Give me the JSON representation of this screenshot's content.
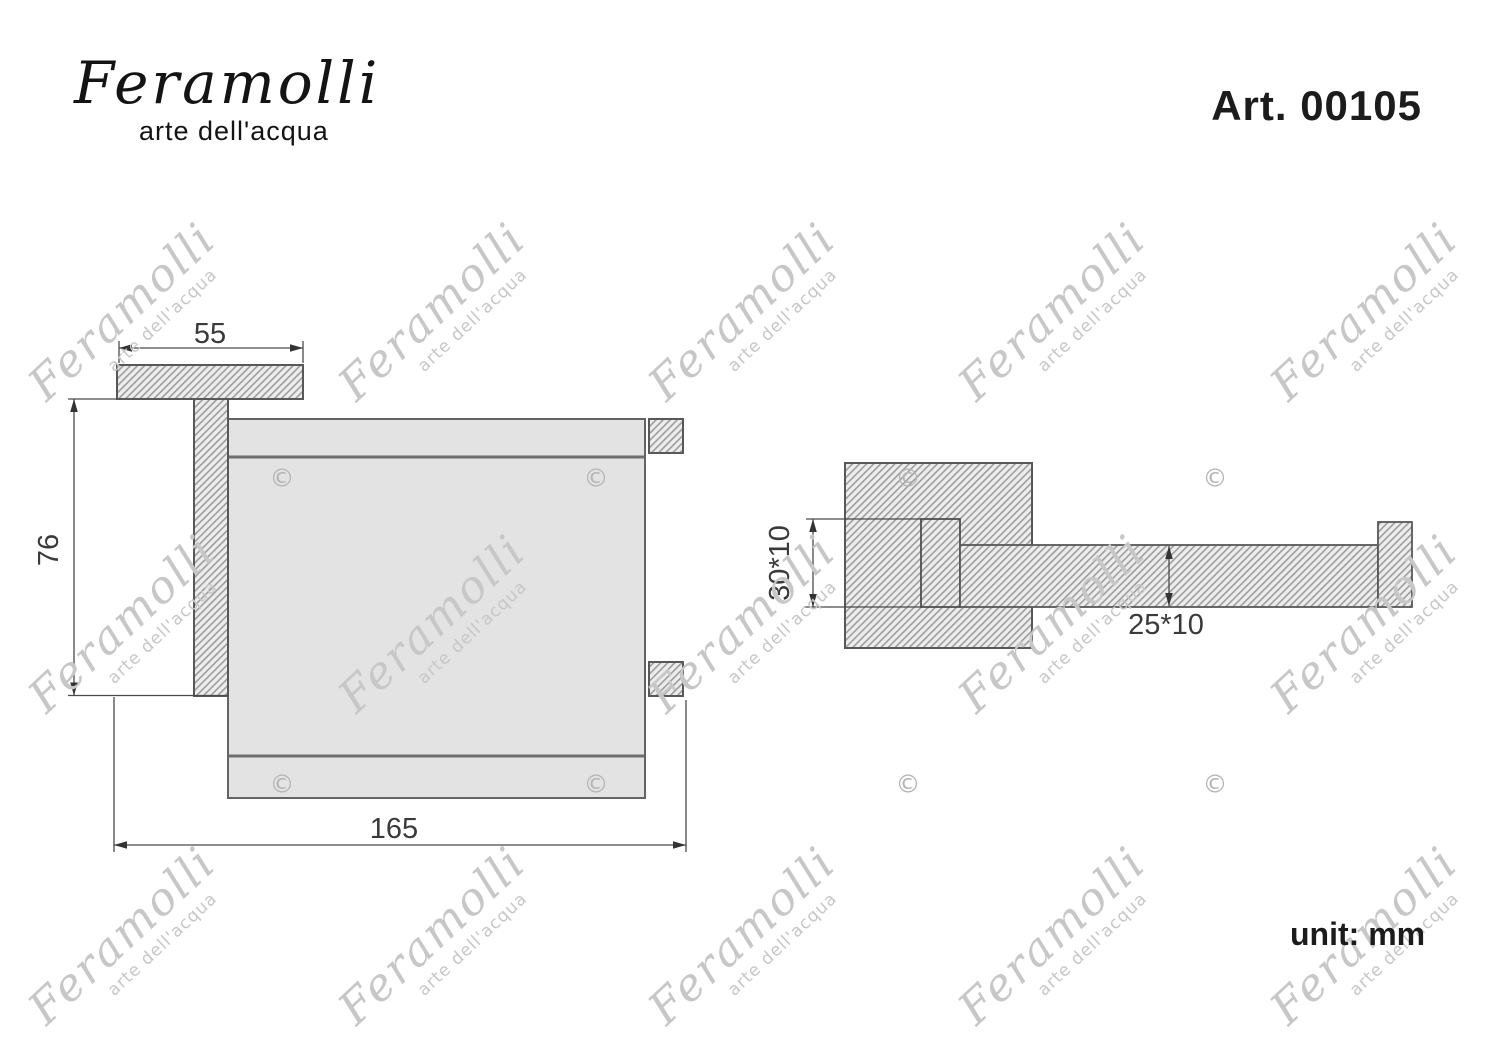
{
  "header": {
    "logo_text": "Feramolli",
    "logo_tagline": "arte dell'acqua",
    "article_label": "Art. 00105"
  },
  "footer": {
    "unit_label": "unit: mm"
  },
  "watermark": {
    "script_text": "Feramolli",
    "tagline": "arte dell'acqua",
    "copyright_glyph": "©",
    "color": "#c7c7c7"
  },
  "drawing": {
    "type": "technical-diagram",
    "colors": {
      "body_fill": "#e3e3e3",
      "outline": "#58585a",
      "hatch_line": "#9d9d9d",
      "dimension_line": "#4a4a4a"
    },
    "front_view": {
      "dim_plate_width": "55",
      "dim_height": "76",
      "dim_total_width": "165"
    },
    "side_view": {
      "dim_wall_profile": "30*10",
      "dim_arm_profile": "25*10"
    }
  }
}
